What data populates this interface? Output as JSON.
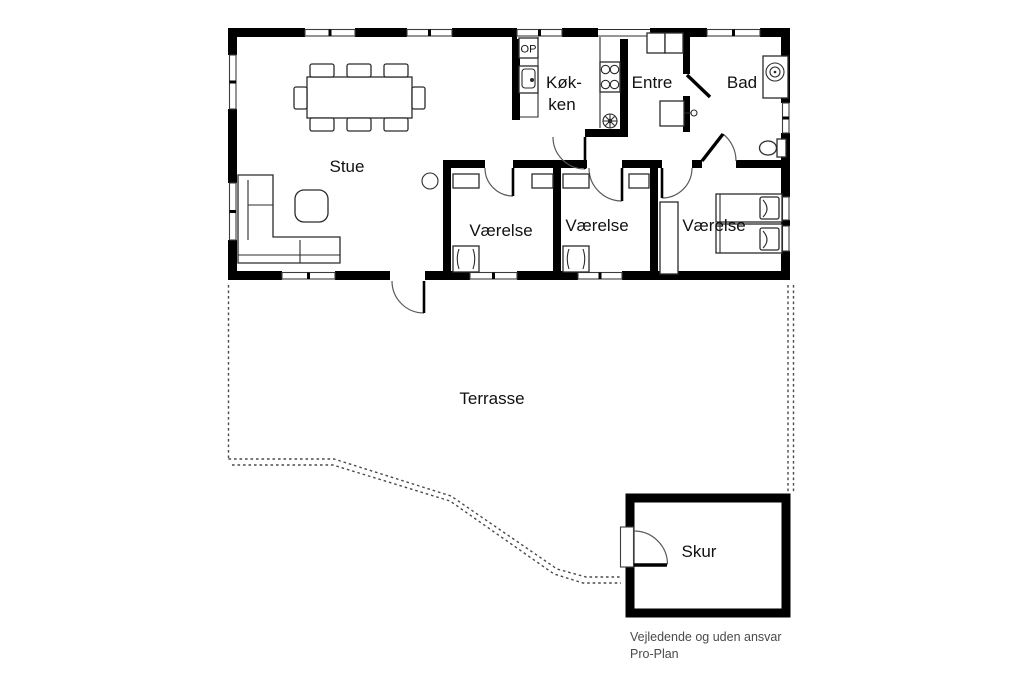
{
  "labels": {
    "stue": "Stue",
    "koekken_line1": "Køk-",
    "koekken_line2": "ken",
    "entre": "Entre",
    "bad": "Bad",
    "vaerelse": "Værelse",
    "terrasse": "Terrasse",
    "skur": "Skur",
    "op": "OP"
  },
  "footer": {
    "disclaimer": "Vejledende og uden ansvar",
    "brand": "Pro-Plan"
  },
  "colors": {
    "wall": "#000000",
    "furniture": "#2b2b2b",
    "window_frame": "#3c3c3c",
    "dashed": "#4a4a4a",
    "label": "#111111",
    "footer_text": "#4a4a4a",
    "background": "#ffffff"
  }
}
